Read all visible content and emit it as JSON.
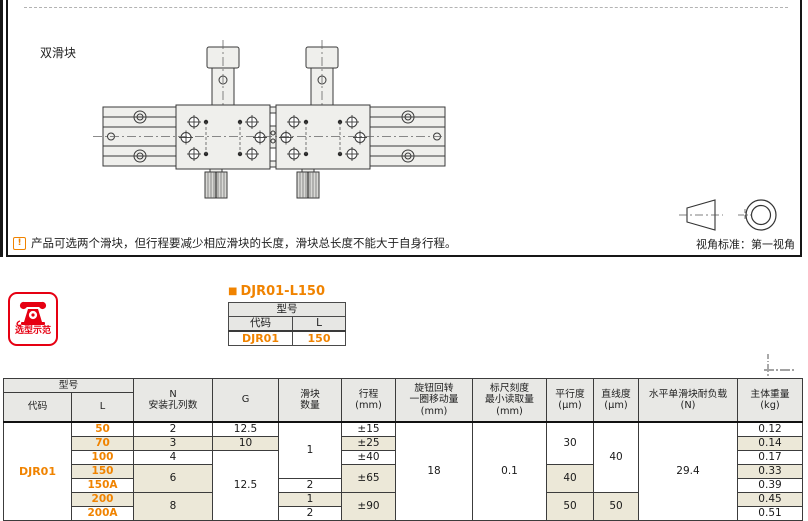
{
  "top": {
    "label": "双滑块",
    "note_icon": "!",
    "note_text": "产品可选两个滑块，但行程要减少相应滑块的长度，滑块总长度不能大于自身行程。",
    "view_label": "视角标准：第一视角"
  },
  "example": {
    "badge": "选型示范",
    "bullet": "■",
    "heading": "DJR01-L150",
    "mini_table": {
      "title": "型号",
      "headers": [
        "代码",
        "L"
      ],
      "values": [
        "DJR01",
        "150"
      ]
    }
  },
  "spec_table": {
    "header": {
      "model": "型号",
      "code": "代码",
      "l": "L",
      "cols": [
        "N\n安装孔列数",
        "G",
        "滑块\n数量",
        "行程\n(mm)",
        "旋钮回转\n一圈移动量\n(mm)",
        "标尺刻度\n最小读取量\n(mm)",
        "平行度\n(μm)",
        "直线度\n(μm)",
        "水平单滑块耐负载\n(N)",
        "主体重量\n(kg)"
      ]
    },
    "col_widths": [
      68,
      62,
      79,
      66,
      63,
      54,
      77,
      74,
      47,
      45,
      99,
      65
    ],
    "rows": [
      [
        {
          "t": "DJR01",
          "rs": 7,
          "c": "code"
        },
        {
          "t": "50",
          "c": "lval"
        },
        {
          "t": "2"
        },
        {
          "t": "12.5"
        },
        {
          "t": "1",
          "rs": 4
        },
        {
          "t": "±15"
        },
        {
          "t": "18",
          "rs": 7
        },
        {
          "t": "0.1",
          "rs": 7
        },
        {
          "t": "30",
          "rs": 3
        },
        {
          "t": "40",
          "rs": 5
        },
        {
          "t": "29.4",
          "rs": 7
        },
        {
          "t": "0.12"
        }
      ],
      [
        {
          "t": "70",
          "c": "lval"
        },
        {
          "t": "3"
        },
        {
          "t": "10"
        },
        {
          "t": "±25"
        },
        {
          "t": "0.14"
        }
      ],
      [
        {
          "t": "100",
          "c": "lval"
        },
        {
          "t": "4"
        },
        {
          "t": "12.5",
          "rs": 5
        },
        {
          "t": "±40"
        },
        {
          "t": "0.17"
        }
      ],
      [
        {
          "t": "150",
          "c": "lval"
        },
        {
          "t": "6",
          "rs": 2
        },
        {
          "t": "±65",
          "rs": 2
        },
        {
          "t": "40",
          "rs": 2
        },
        {
          "t": "0.33"
        }
      ],
      [
        {
          "t": "150A",
          "c": "lval"
        },
        {
          "t": "2"
        },
        {
          "t": "0.39"
        }
      ],
      [
        {
          "t": "200",
          "c": "lval"
        },
        {
          "t": "8",
          "rs": 2
        },
        {
          "t": "1"
        },
        {
          "t": "±90",
          "rs": 2
        },
        {
          "t": "50",
          "rs": 2
        },
        {
          "t": "50",
          "rs": 2
        },
        {
          "t": "0.45"
        }
      ],
      [
        {
          "t": "200A",
          "c": "lval"
        },
        {
          "t": "2"
        },
        {
          "t": "0.51"
        }
      ]
    ]
  },
  "colors": {
    "accent_orange": "#f08300",
    "badge_red": "#e60012",
    "stripe_beige": "#ece8d8",
    "header_gray": "#e8e8e5"
  }
}
